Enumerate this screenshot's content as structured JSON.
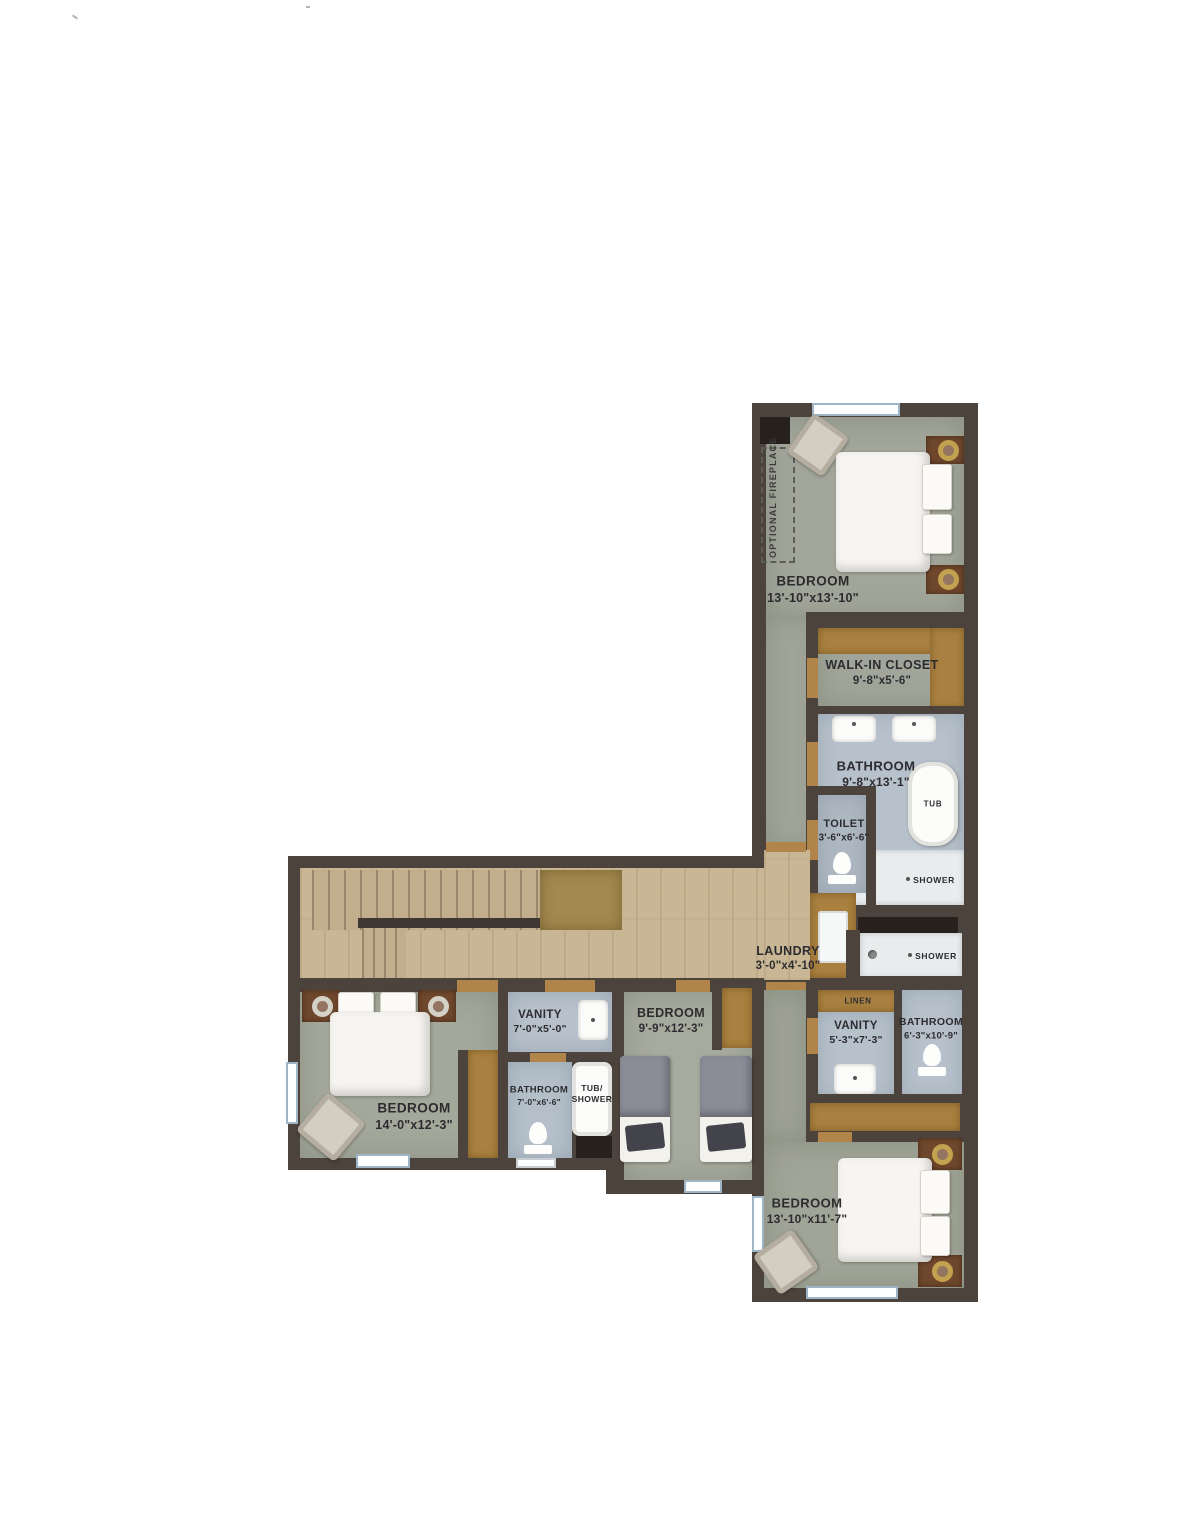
{
  "page": {
    "type": "floor-plan-scan",
    "background": "#ffffff"
  },
  "palette": {
    "wall": "#4c433c",
    "bedroom_floor": "#a2a69a",
    "bath_floor": "#b7c1cb",
    "hall_wood": "#c8b694",
    "stair_landing": "#a3894e",
    "closet_wood": "#a9803f",
    "fixture_white": "#f7f5f1",
    "label_text": "#2c2c30"
  },
  "rooms": {
    "bedroom_master": {
      "name": "BEDROOM",
      "dims": "13'-10\"x13'-10\""
    },
    "walk_in_closet": {
      "name": "WALK-IN CLOSET",
      "dims": "9'-8\"x5'-6\""
    },
    "bathroom_master": {
      "name": "BATHROOM",
      "dims": "9'-8\"x13'-1\""
    },
    "toilet_room": {
      "name": "TOILET",
      "dims": "3'-6\"x6'-6\""
    },
    "laundry": {
      "name": "LAUNDRY",
      "dims": "3'-0\"x4'-10\""
    },
    "vanity_right": {
      "name": "VANITY",
      "dims": "5'-3\"x7'-3\""
    },
    "bathroom_right": {
      "name": "BATHROOM",
      "dims": "6'-3\"x10'-9\""
    },
    "bedroom_bottom": {
      "name": "BEDROOM",
      "dims": "13'-10\"x11'-7\""
    },
    "bedroom_left": {
      "name": "BEDROOM",
      "dims": "14'-0\"x12'-3\""
    },
    "vanity_left": {
      "name": "VANITY",
      "dims": "7'-0\"x5'-0\""
    },
    "bathroom_middle": {
      "name": "BATHROOM",
      "dims": "7'-0\"x6'-6\""
    },
    "bedroom_middle": {
      "name": "BEDROOM",
      "dims": "9'-9\"x12'-3\""
    }
  },
  "fixtures": {
    "tub": "TUB",
    "shower_master": "SHOWER",
    "shower_hall": "SHOWER",
    "linen": "LINEN",
    "tub_shower_line1": "TUB/",
    "tub_shower_line2": "SHOWER",
    "optional_fireplace": "OPTIONAL FIREPLACE"
  }
}
